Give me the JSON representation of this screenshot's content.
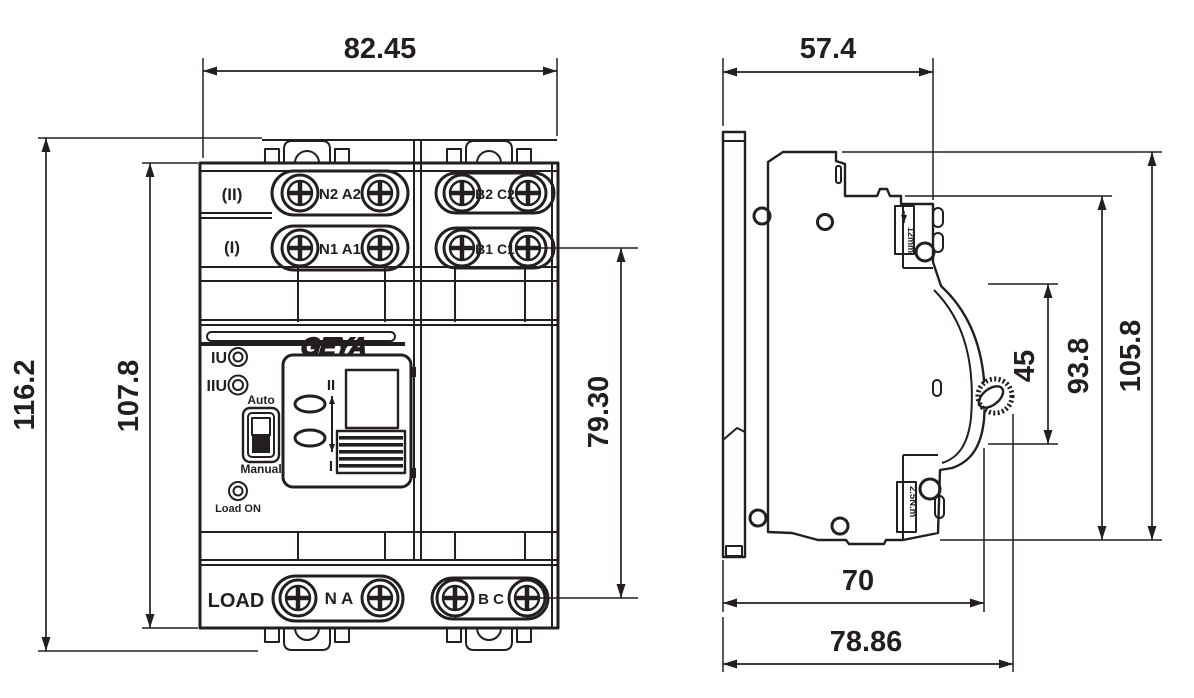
{
  "drawing": {
    "brand_logo": "GEYA",
    "front": {
      "row_II_label": "(II)",
      "row_II_left_terminals": "N2 A2",
      "row_II_right_terminals": "B2 C2",
      "row_I_label": "(I)",
      "row_I_left_terminals": "N1 A1",
      "row_I_right_terminals": "B1 C1",
      "led_I_label": "IU",
      "led_II_label": "IIU",
      "mode_up_label": "Auto",
      "mode_down_label": "Manual",
      "load_led_label": "Load ON",
      "load_label": "LOAD",
      "load_left_terminals": "N A",
      "load_right_terminals": "B C",
      "position_top": "II",
      "position_bottom": "I",
      "dim_width": "82.45",
      "dim_height_overall": "116.2",
      "dim_height_body": "107.8",
      "dim_terminal_span": "79.30"
    },
    "side": {
      "strip_length_label": "12mm",
      "torque_label": "2.5N.m",
      "dim_depth_top": "57.4",
      "dim_height_overall": "105.8",
      "dim_height_rail": "93.8",
      "dim_handle_span": "45",
      "dim_depth_body": "70",
      "dim_depth_overall": "78.86"
    }
  }
}
